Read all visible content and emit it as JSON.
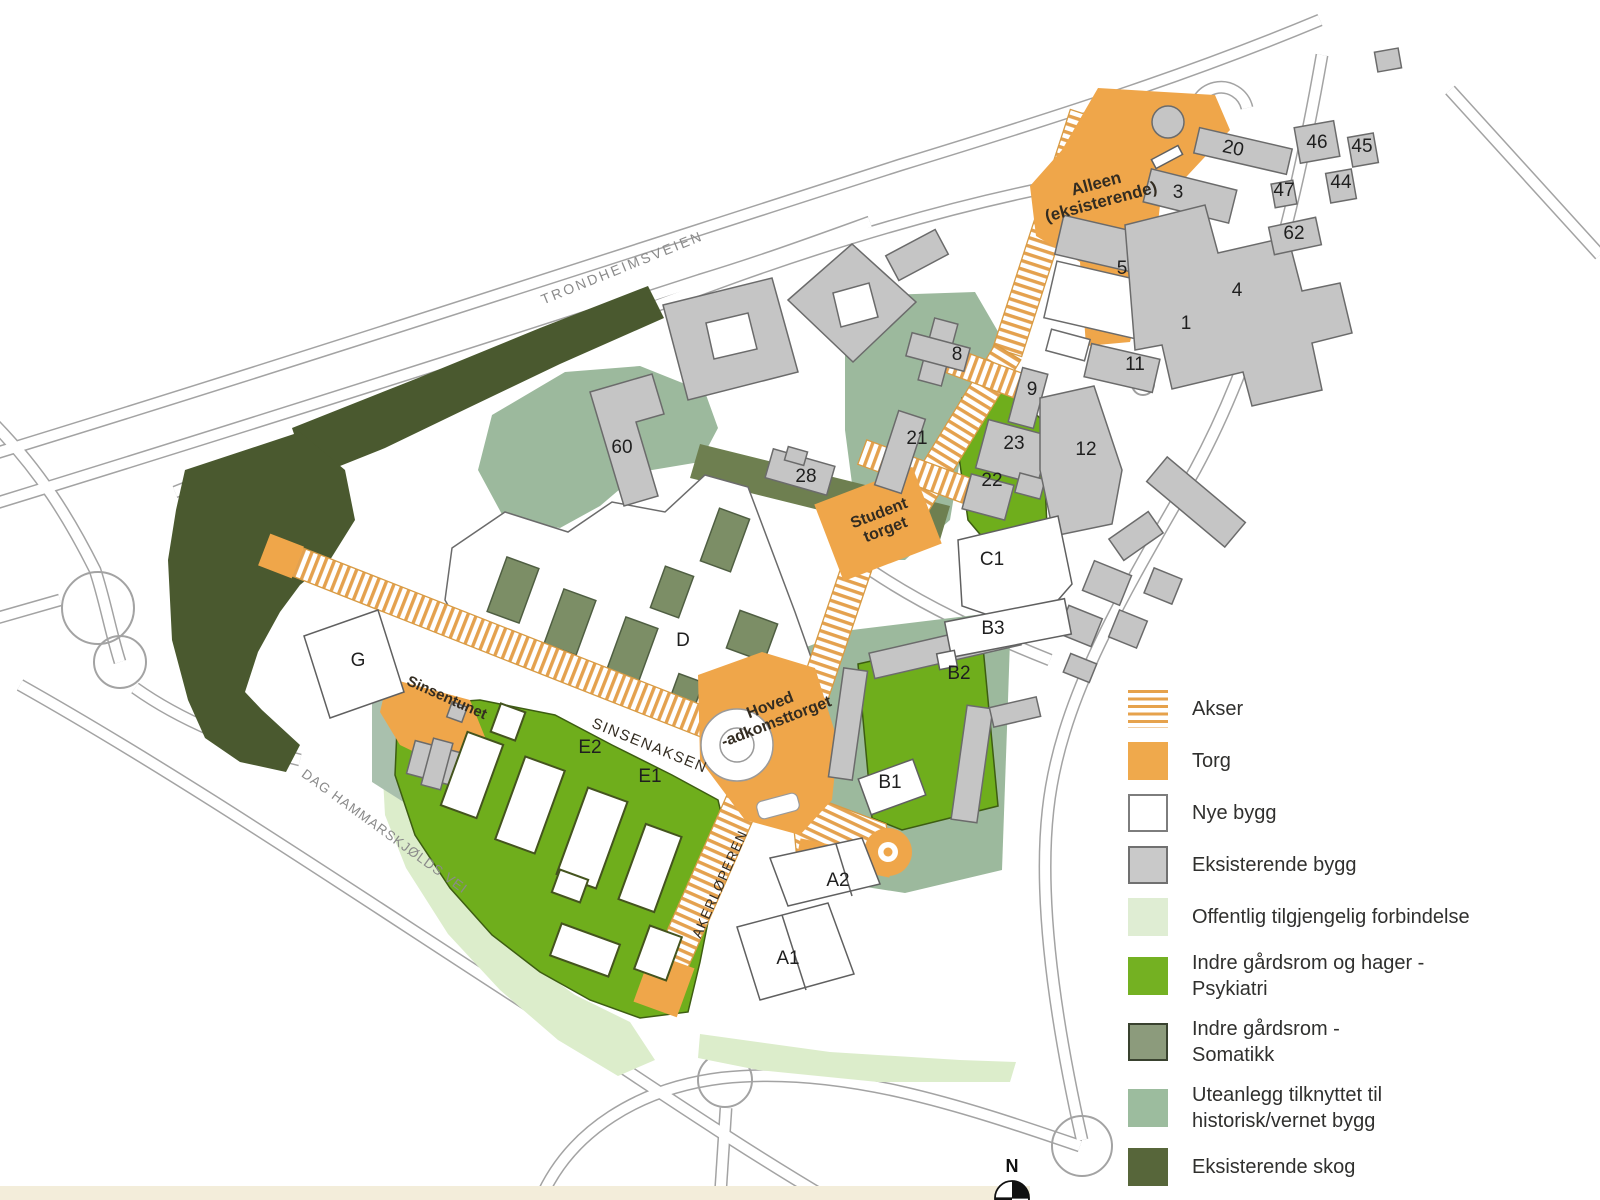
{
  "map": {
    "north_label": "N",
    "colors": {
      "torg_orange": "#EFA64A",
      "akser_stripe": "#E4A14E",
      "nye_bygg": "#FFFFFF",
      "eksisterende_bygg": "#C5C5C5",
      "offentlig_forbindelse": "#DCEDCB",
      "psykiatri_green": "#6FAE1C",
      "somatikk_green": "#7C8E66",
      "historisk_sage": "#9CB99D",
      "skog_dark": "#4A592F"
    },
    "road_labels": [
      {
        "id": "trondheimsveien",
        "text": "TRONDHEIMSVEIEN",
        "x": 624,
        "y": 272,
        "rotate": -22,
        "size": 14,
        "spacing": 2.5
      },
      {
        "id": "dag-hammarskjolds-vei",
        "text": "DAG HAMMARSKJØLDS VEI",
        "x": 382,
        "y": 835,
        "rotate": 36,
        "size": 13.5,
        "spacing": 1
      }
    ],
    "area_labels": [
      {
        "id": "alleen",
        "text": "Alleen\n(eksisterende)",
        "x": 1100,
        "y": 198,
        "rotate": -15,
        "size": 17,
        "bold": true
      },
      {
        "id": "student-torget",
        "text": "Student\ntorget",
        "x": 884,
        "y": 526,
        "rotate": -21,
        "size": 16,
        "bold": true
      },
      {
        "id": "hoved-adkomsttorget",
        "text": "Hoved\n-adkomsttorget",
        "x": 775,
        "y": 718,
        "rotate": -21,
        "size": 16,
        "bold": true
      },
      {
        "id": "sinsenaksen",
        "text": "SINSENAKSEN",
        "x": 648,
        "y": 750,
        "rotate": 22,
        "size": 15,
        "spacing": 1.5
      },
      {
        "id": "akerloperen",
        "text": "AKERLØPEREN",
        "x": 724,
        "y": 886,
        "rotate": -66,
        "size": 14,
        "spacing": 1
      },
      {
        "id": "sinsentunet",
        "text": "Sinsentunet",
        "x": 445,
        "y": 702,
        "rotate": 24,
        "size": 15,
        "bold": true
      }
    ],
    "building_labels": [
      {
        "text": "46",
        "x": 1317,
        "y": 148
      },
      {
        "text": "45",
        "x": 1362,
        "y": 152
      },
      {
        "text": "44",
        "x": 1341,
        "y": 188
      },
      {
        "text": "47",
        "x": 1284,
        "y": 196
      },
      {
        "text": "62",
        "x": 1294,
        "y": 239
      },
      {
        "text": "20",
        "x": 1232,
        "y": 154,
        "rotate": 12
      },
      {
        "text": "3",
        "x": 1178,
        "y": 198
      },
      {
        "text": "5",
        "x": 1122,
        "y": 274
      },
      {
        "text": "4",
        "x": 1237,
        "y": 296
      },
      {
        "text": "1",
        "x": 1186,
        "y": 329
      },
      {
        "text": "11",
        "x": 1135,
        "y": 370
      },
      {
        "text": "8",
        "x": 957,
        "y": 360
      },
      {
        "text": "9",
        "x": 1032,
        "y": 395
      },
      {
        "text": "21",
        "x": 917,
        "y": 444
      },
      {
        "text": "23",
        "x": 1014,
        "y": 449
      },
      {
        "text": "22",
        "x": 992,
        "y": 486
      },
      {
        "text": "12",
        "x": 1086,
        "y": 455
      },
      {
        "text": "C1",
        "x": 992,
        "y": 565
      },
      {
        "text": "B3",
        "x": 993,
        "y": 634
      },
      {
        "text": "B2",
        "x": 959,
        "y": 679
      },
      {
        "text": "B1",
        "x": 890,
        "y": 788
      },
      {
        "text": "60",
        "x": 622,
        "y": 453
      },
      {
        "text": "28",
        "x": 806,
        "y": 482
      },
      {
        "text": "D",
        "x": 683,
        "y": 646
      },
      {
        "text": "G",
        "x": 358,
        "y": 666
      },
      {
        "text": "E2",
        "x": 590,
        "y": 753
      },
      {
        "text": "E1",
        "x": 650,
        "y": 782
      },
      {
        "text": "A2",
        "x": 838,
        "y": 886
      },
      {
        "text": "A1",
        "x": 788,
        "y": 964
      }
    ]
  },
  "legend": {
    "items": [
      {
        "id": "akser",
        "label": "Akser",
        "swatch": "stripes"
      },
      {
        "id": "torg",
        "label": "Torg",
        "swatch": "#EFA94C"
      },
      {
        "id": "nye-bygg",
        "label": "Nye bygg",
        "swatch": "#FFFFFF",
        "border": "#7d7d7d"
      },
      {
        "id": "eksisterende-bygg",
        "label": "Eksisterende bygg",
        "swatch": "#C9C9C9",
        "border": "#707070"
      },
      {
        "id": "offentlig-tilgjengelig-forbindelse",
        "label": "Offentlig tilgjengelig forbindelse",
        "swatch": "#DFEDD3"
      },
      {
        "id": "indre-gardsrom-psykiatri",
        "label": "Indre gårdsrom og hager -\nPsykiatri",
        "swatch": "#74B122"
      },
      {
        "id": "indre-gardsrom-somatikk",
        "label": "Indre gårdsrom -\nSomatikk",
        "swatch": "#8C9B7C",
        "border": "#39422f"
      },
      {
        "id": "uteanlegg-historisk",
        "label": "Uteanlegg tilknyttet til\nhistorisk/vernet bygg",
        "swatch": "#9CBC9E"
      },
      {
        "id": "eksisterende-skog",
        "label": "Eksisterende skog",
        "swatch": "#57663A"
      }
    ]
  }
}
